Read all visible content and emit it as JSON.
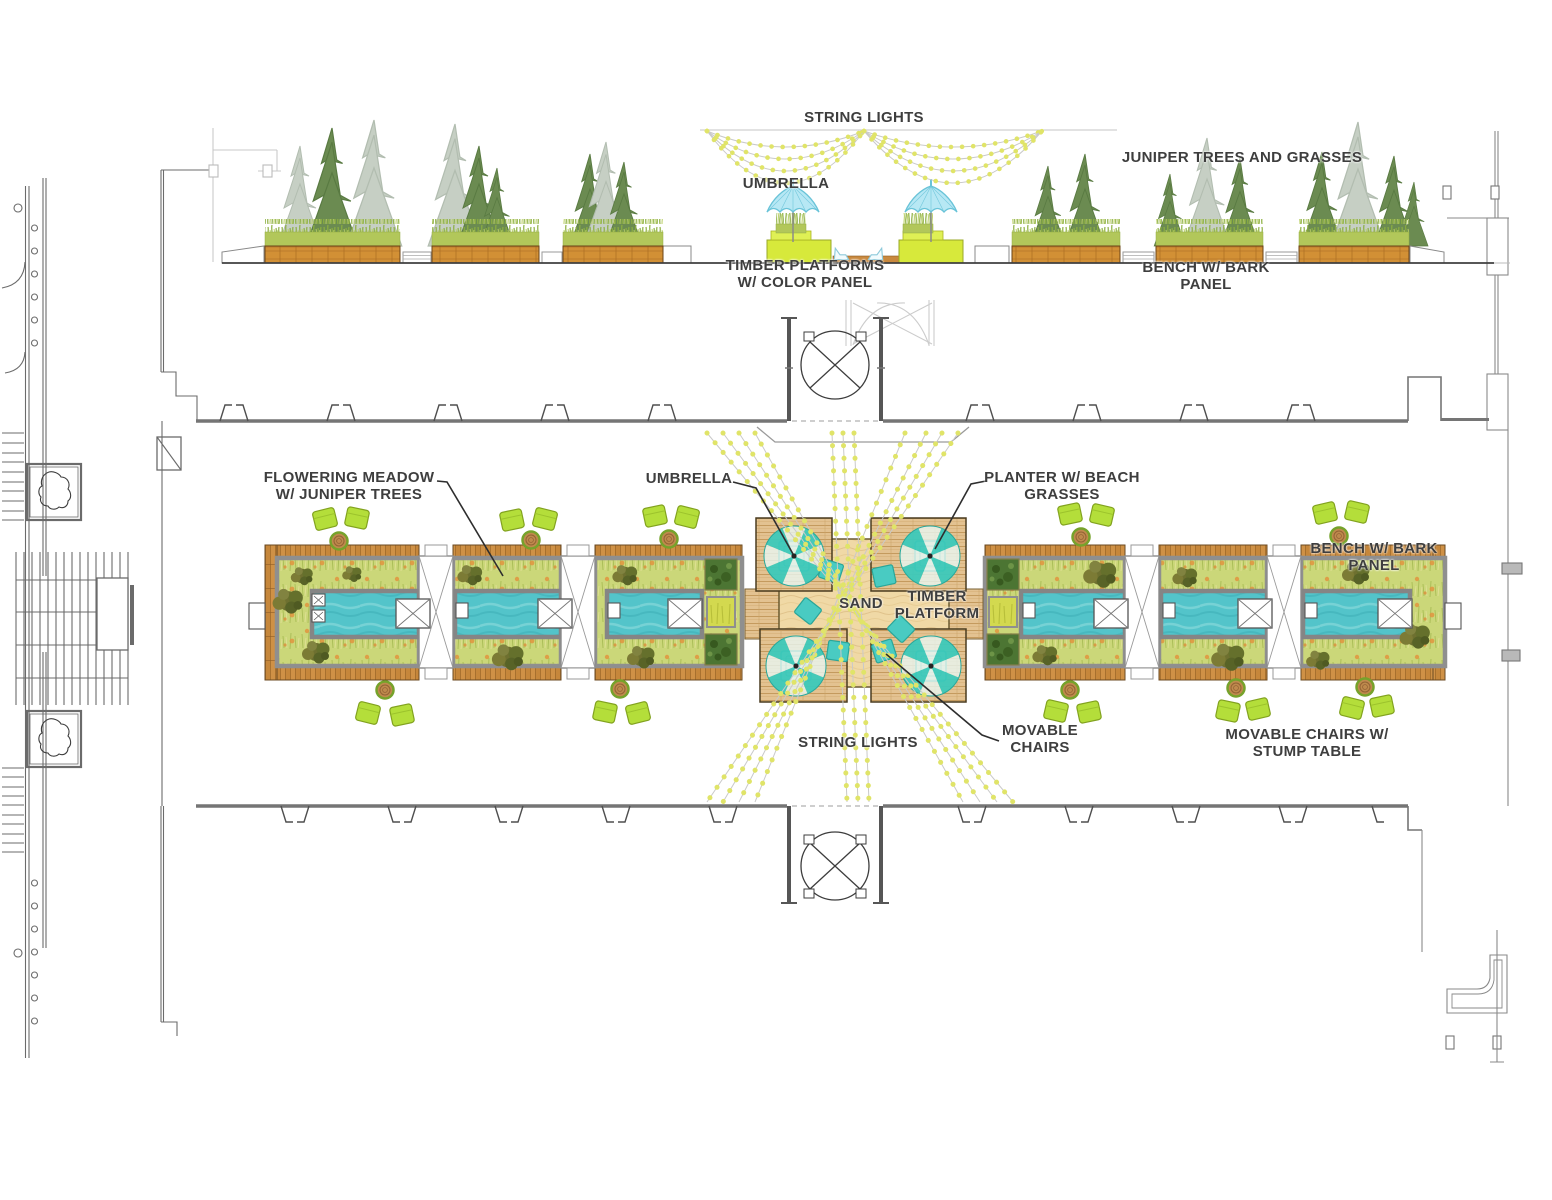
{
  "drawing_labels": {
    "string_lights_top": "STRING LIGHTS",
    "juniper_trees": "JUNIPER TREES AND GRASSES",
    "umbrella_elevation": "UMBRELLA",
    "timber_platforms": "TIMBER PLATFORMS\nW/ COLOR PANEL",
    "bench_bark_elevation": "BENCH W/ BARK\nPANEL",
    "flowering_meadow": "FLOWERING MEADOW\nW/ JUNIPER TREES",
    "umbrella_plan": "UMBRELLA",
    "planter_beach": "PLANTER W/ BEACH\nGRASSES",
    "bench_bark_plan": "BENCH W/ BARK PANEL",
    "sand": "SAND",
    "timber_platform": "TIMBER\nPLATFORM",
    "string_lights_bottom": "STRING LIGHTS",
    "movable_chairs": "MOVABLE\nCHAIRS",
    "movable_chairs_stump": "MOVABLE CHAIRS W/\nSTUMP TABLE"
  },
  "palette": {
    "water": "#56C5CB",
    "sand": "#F0D9A6",
    "wood": "#C9893E",
    "meadow": "#CCD878",
    "movable_chair": "#B5DF35",
    "umbrella_plan": "#3EC9BA",
    "umbrella_elevation": "#B9E9F5",
    "platform_color_panel": "#D7E93B",
    "string_lights": "#E3E66B",
    "planter_frame": "#8F8F8F",
    "label_text": "#3E3E3E",
    "tree_green": "#6B8B51",
    "tree_faded": "#C6CFC4",
    "linework": "#6B6B6B"
  }
}
